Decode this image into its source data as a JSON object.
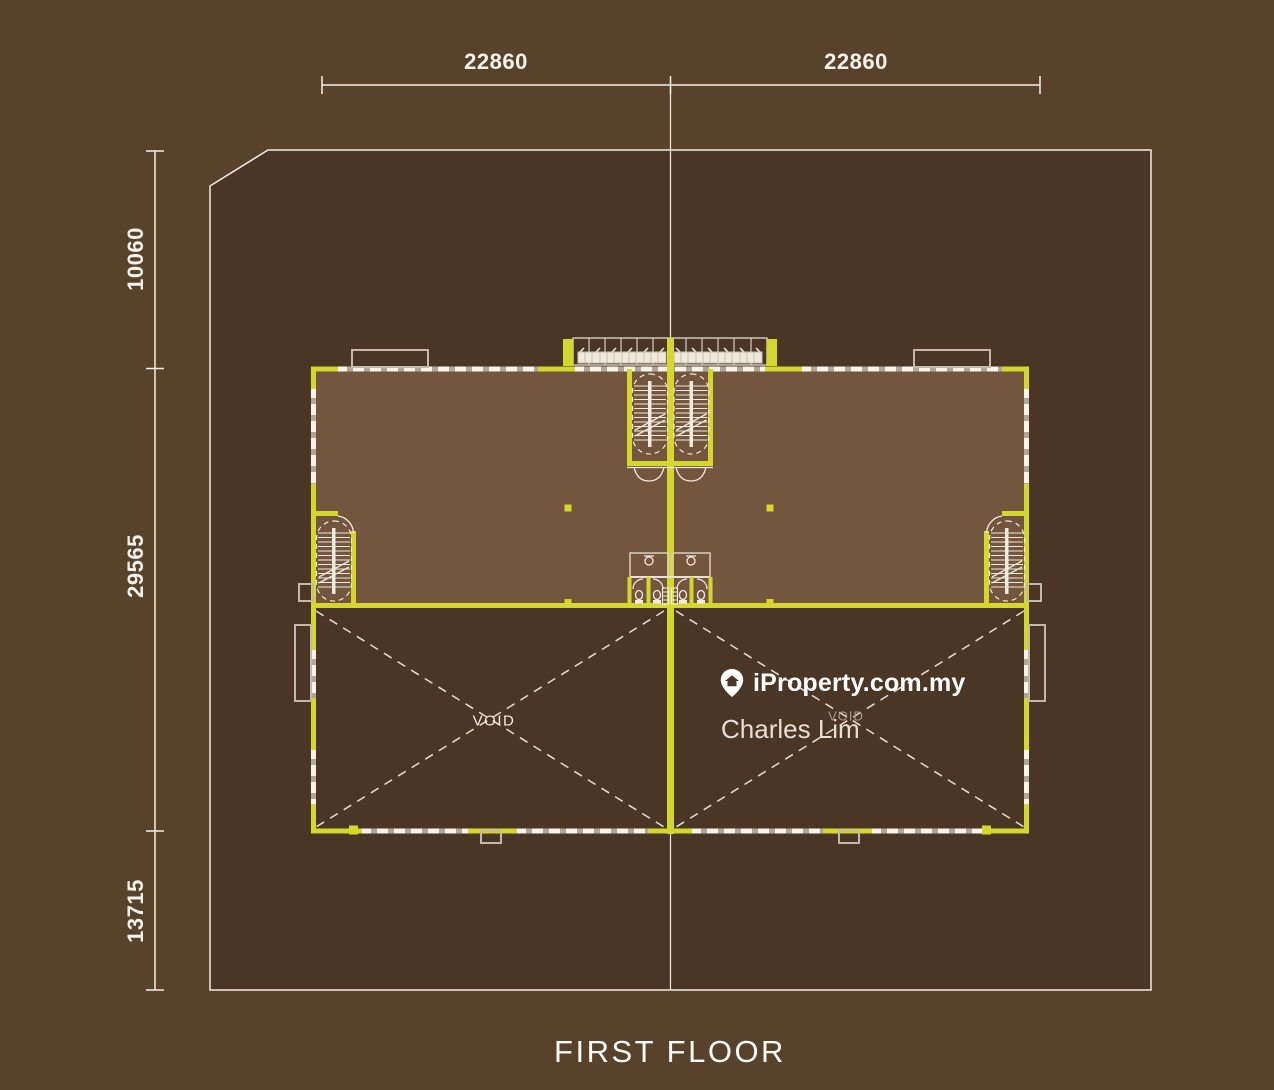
{
  "title": "FIRST FLOOR",
  "dimensions": {
    "top_left": "22860",
    "top_right": "22860",
    "side_top": "10060",
    "side_middle": "29565",
    "side_bottom": "13715"
  },
  "labels": {
    "void_left": "VOID",
    "void_right": "VOID"
  },
  "watermark": {
    "brand": "iProperty.com.my",
    "agent": "Charles Lim",
    "icon": "location-pin-icon"
  },
  "colors": {
    "background": "#59422c",
    "plot_fill": "#4b3525",
    "floor_fill": "#73563d",
    "wall_accent": "#d5d72e",
    "line_white": "#f1ebe1"
  }
}
